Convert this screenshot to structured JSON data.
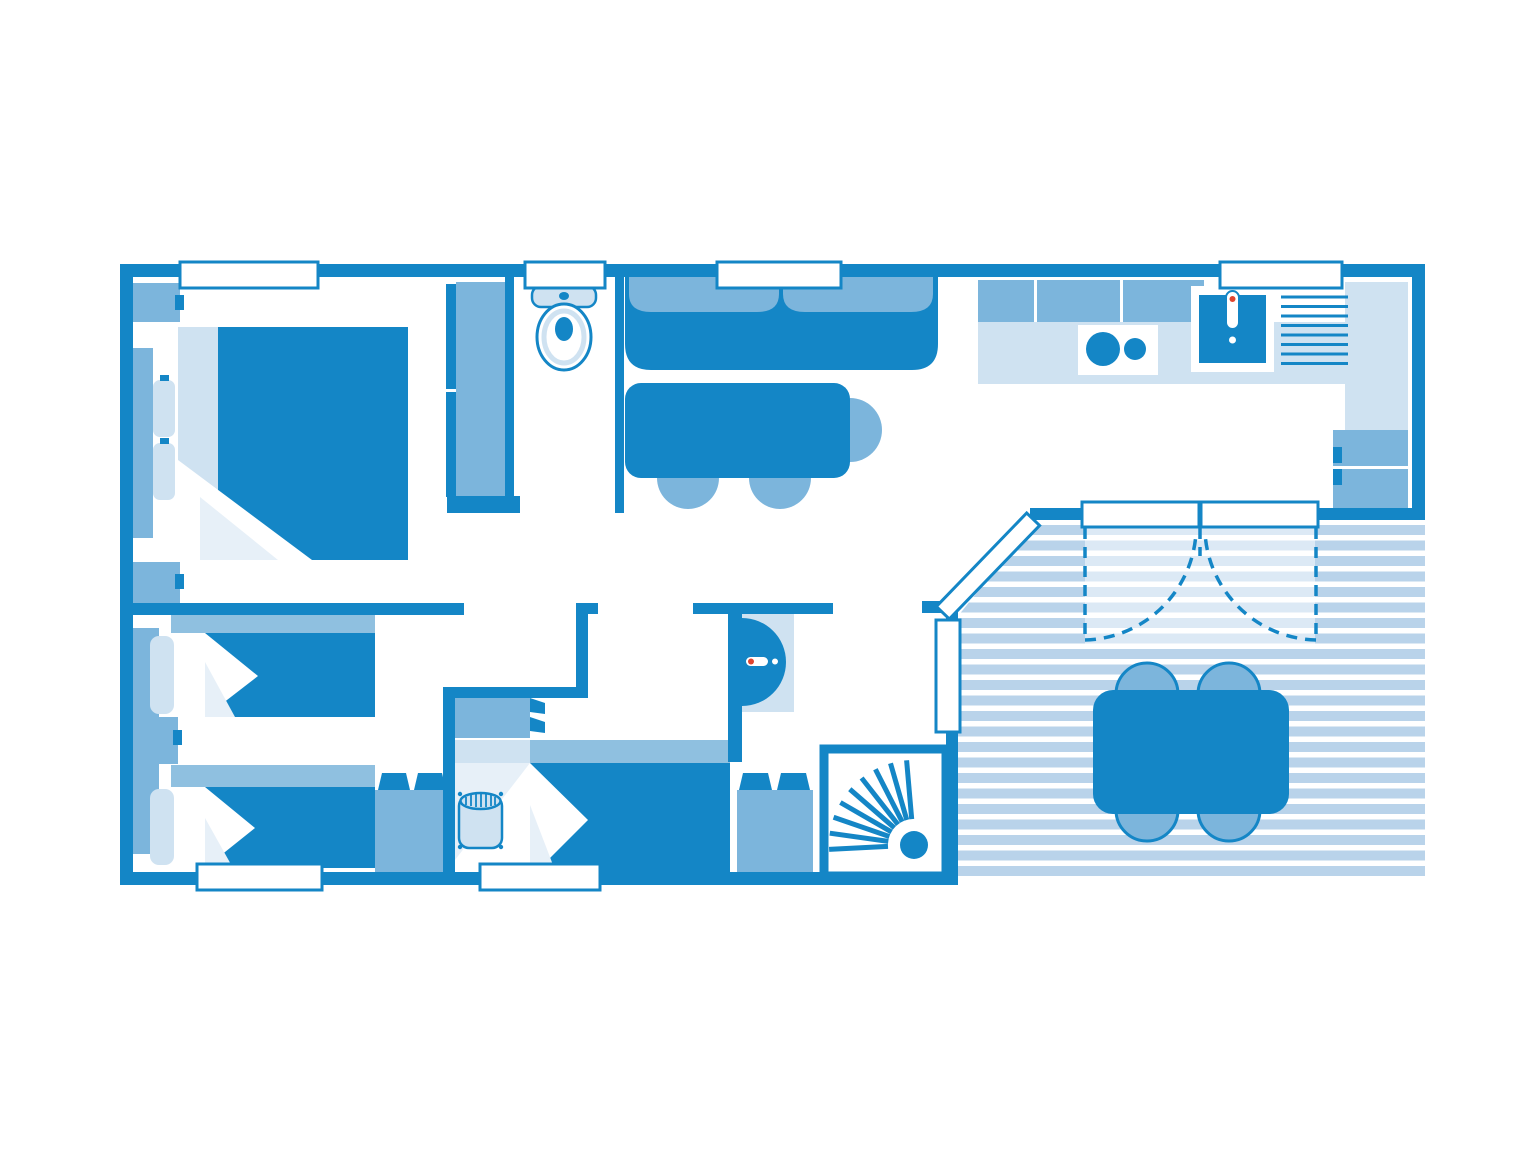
{
  "title": "Mobile home floor plan (2 bedrooms layout, blue schematic)",
  "colors": {
    "dark": "#1486c6",
    "mid": "#7cb5dc",
    "light": "#cfe2f1",
    "xlight": "#e7f0f8",
    "band": "#8fc0e0",
    "stripe": "#b9d3ea",
    "red": "#e0452f",
    "paper": "#ffffff"
  },
  "plan": {
    "rooms": [
      {
        "name": "master-bedroom",
        "fixtures": [
          "double-bed",
          "two-pillows",
          "nightstand-top",
          "nightstand-bottom",
          "wardrobe"
        ]
      },
      {
        "name": "wc",
        "fixtures": [
          "toilet"
        ]
      },
      {
        "name": "living-room",
        "fixtures": [
          "sofa",
          "dining-table",
          "three-chairs"
        ]
      },
      {
        "name": "kitchen",
        "fixtures": [
          "upper-cabinets",
          "worktop",
          "stove-two-burners",
          "sink-with-faucet",
          "drainer",
          "tall-cupboard"
        ]
      },
      {
        "name": "twin-bedroom",
        "fixtures": [
          "single-bed-top",
          "single-bed-bottom",
          "wardrobe",
          "nightstand",
          "dresser"
        ]
      },
      {
        "name": "third-bedroom",
        "fixtures": [
          "single-bed",
          "headboard-cabinet",
          "laundry-basket"
        ]
      },
      {
        "name": "shower-room",
        "fixtures": [
          "washbasin",
          "cabinet",
          "shower-tray"
        ]
      },
      {
        "name": "terrace",
        "fixtures": [
          "deck-boards",
          "outdoor-table",
          "four-chairs",
          "double-french-door",
          "entrance-door-diagonal"
        ]
      }
    ],
    "windows_count": 9,
    "deck": {
      "board_color": "#b9d3ea",
      "gap_color": "#ffffff"
    }
  }
}
